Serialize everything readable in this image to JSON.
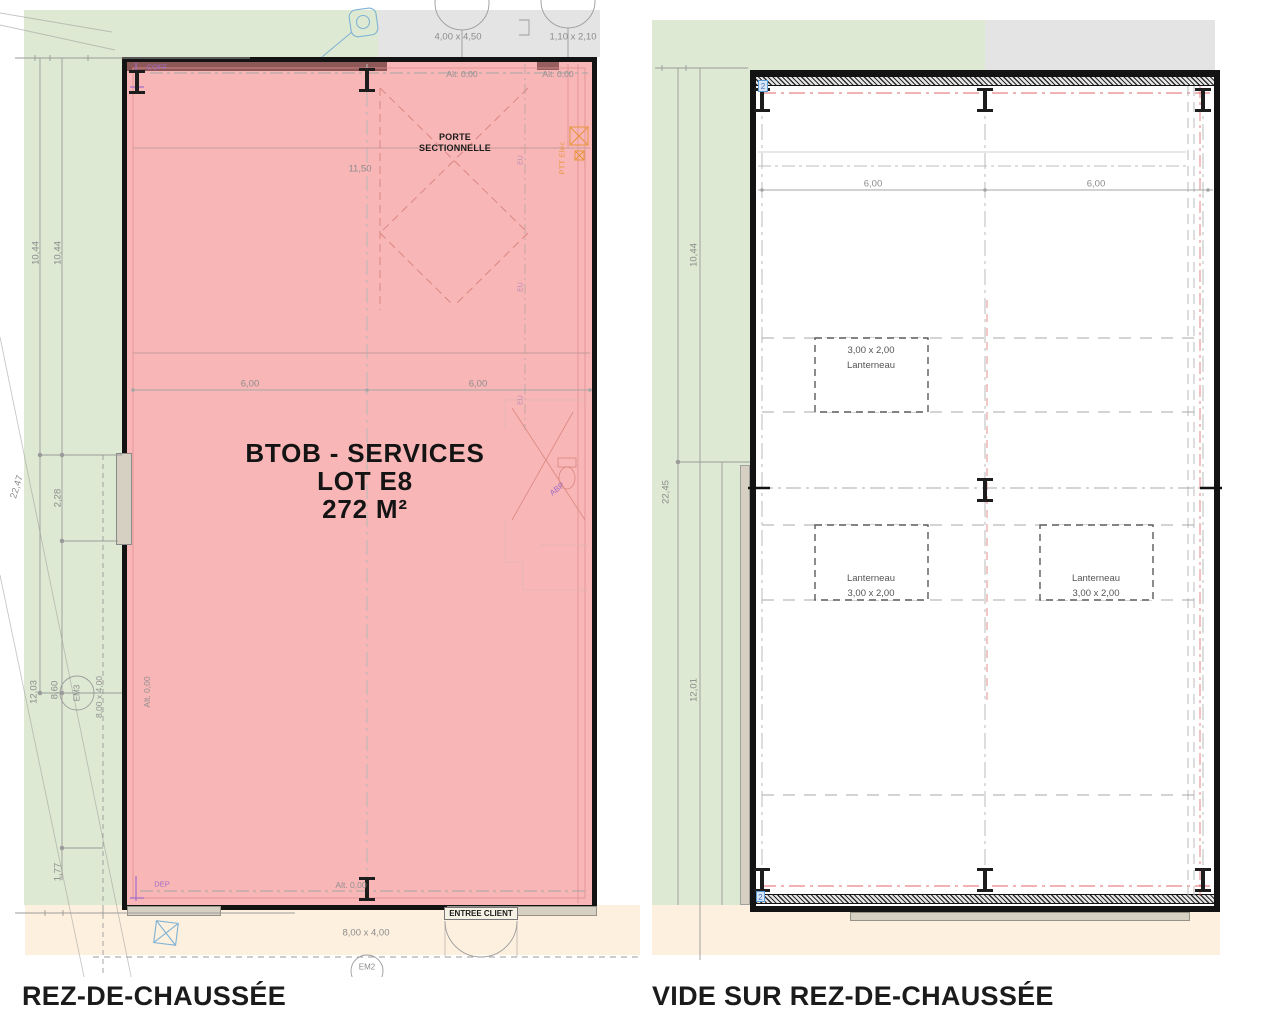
{
  "colors": {
    "green": "#dde9d2",
    "grey_zone": "#e4e4e4",
    "peach": "#fdf0de",
    "pink": "#f9b6b6",
    "wall_dark": "#7d4848",
    "axis_red": "#e06666",
    "annotation_purple": "#a06cc8",
    "annotation_orange": "#e8953a",
    "marker_blue": "#5b9bd5",
    "dim_grey": "#8c8c8c"
  },
  "left_plan": {
    "title": "REZ-DE-CHAUSSÉE",
    "room": {
      "line1": "BTOB - SERVICES",
      "line2": "LOT E8",
      "line3": "272 M²"
    },
    "door_label": {
      "line1": "PORTE",
      "line2": "SECTIONNELLE"
    },
    "entree_client": "ENTREE CLIENT",
    "labels": {
      "coff": "COFF",
      "dep": "DEP",
      "ptt": "PTT Elec",
      "abp": "ABP",
      "eu": "EU"
    },
    "alt": {
      "top_a": "Alt. 0,00",
      "top_b": "Alt. 0,00",
      "bottom": "Alt. 0,00",
      "left": "Alt. 0,00"
    },
    "dims": {
      "door_top": "4,00 x 4,50",
      "door_top2": "1,10 x 2,10",
      "d1150": "11,50",
      "w_half_a": "6,00",
      "w_half_b": "6,00",
      "h_a": "10,44",
      "h_b": "10,44",
      "total": "22,47",
      "d228": "2,28",
      "d1203": "12,03",
      "d860": "8,60",
      "d177": "1,77",
      "em_left": "8,00 x 4,00",
      "em_bottom": "8,00 x 4,00"
    },
    "refs": {
      "em3": "EM3",
      "em2": "EM2"
    }
  },
  "right_plan": {
    "title": "VIDE SUR REZ-DE-CHAUSSÉE",
    "dims": {
      "w_half_a": "6,00",
      "w_half_b": "6,00",
      "h": "10,44",
      "total": "22,45",
      "d1201": "12,01"
    },
    "lanterneaux": [
      {
        "label": "Lanterneau",
        "size": "3,00 x 2,00"
      },
      {
        "label": "Lanterneau",
        "size": "3,00 x 2,00"
      },
      {
        "label": "Lanterneau",
        "size": "3,00 x 2,00"
      }
    ],
    "markers": {
      "top": "2",
      "bottom": "2"
    }
  }
}
